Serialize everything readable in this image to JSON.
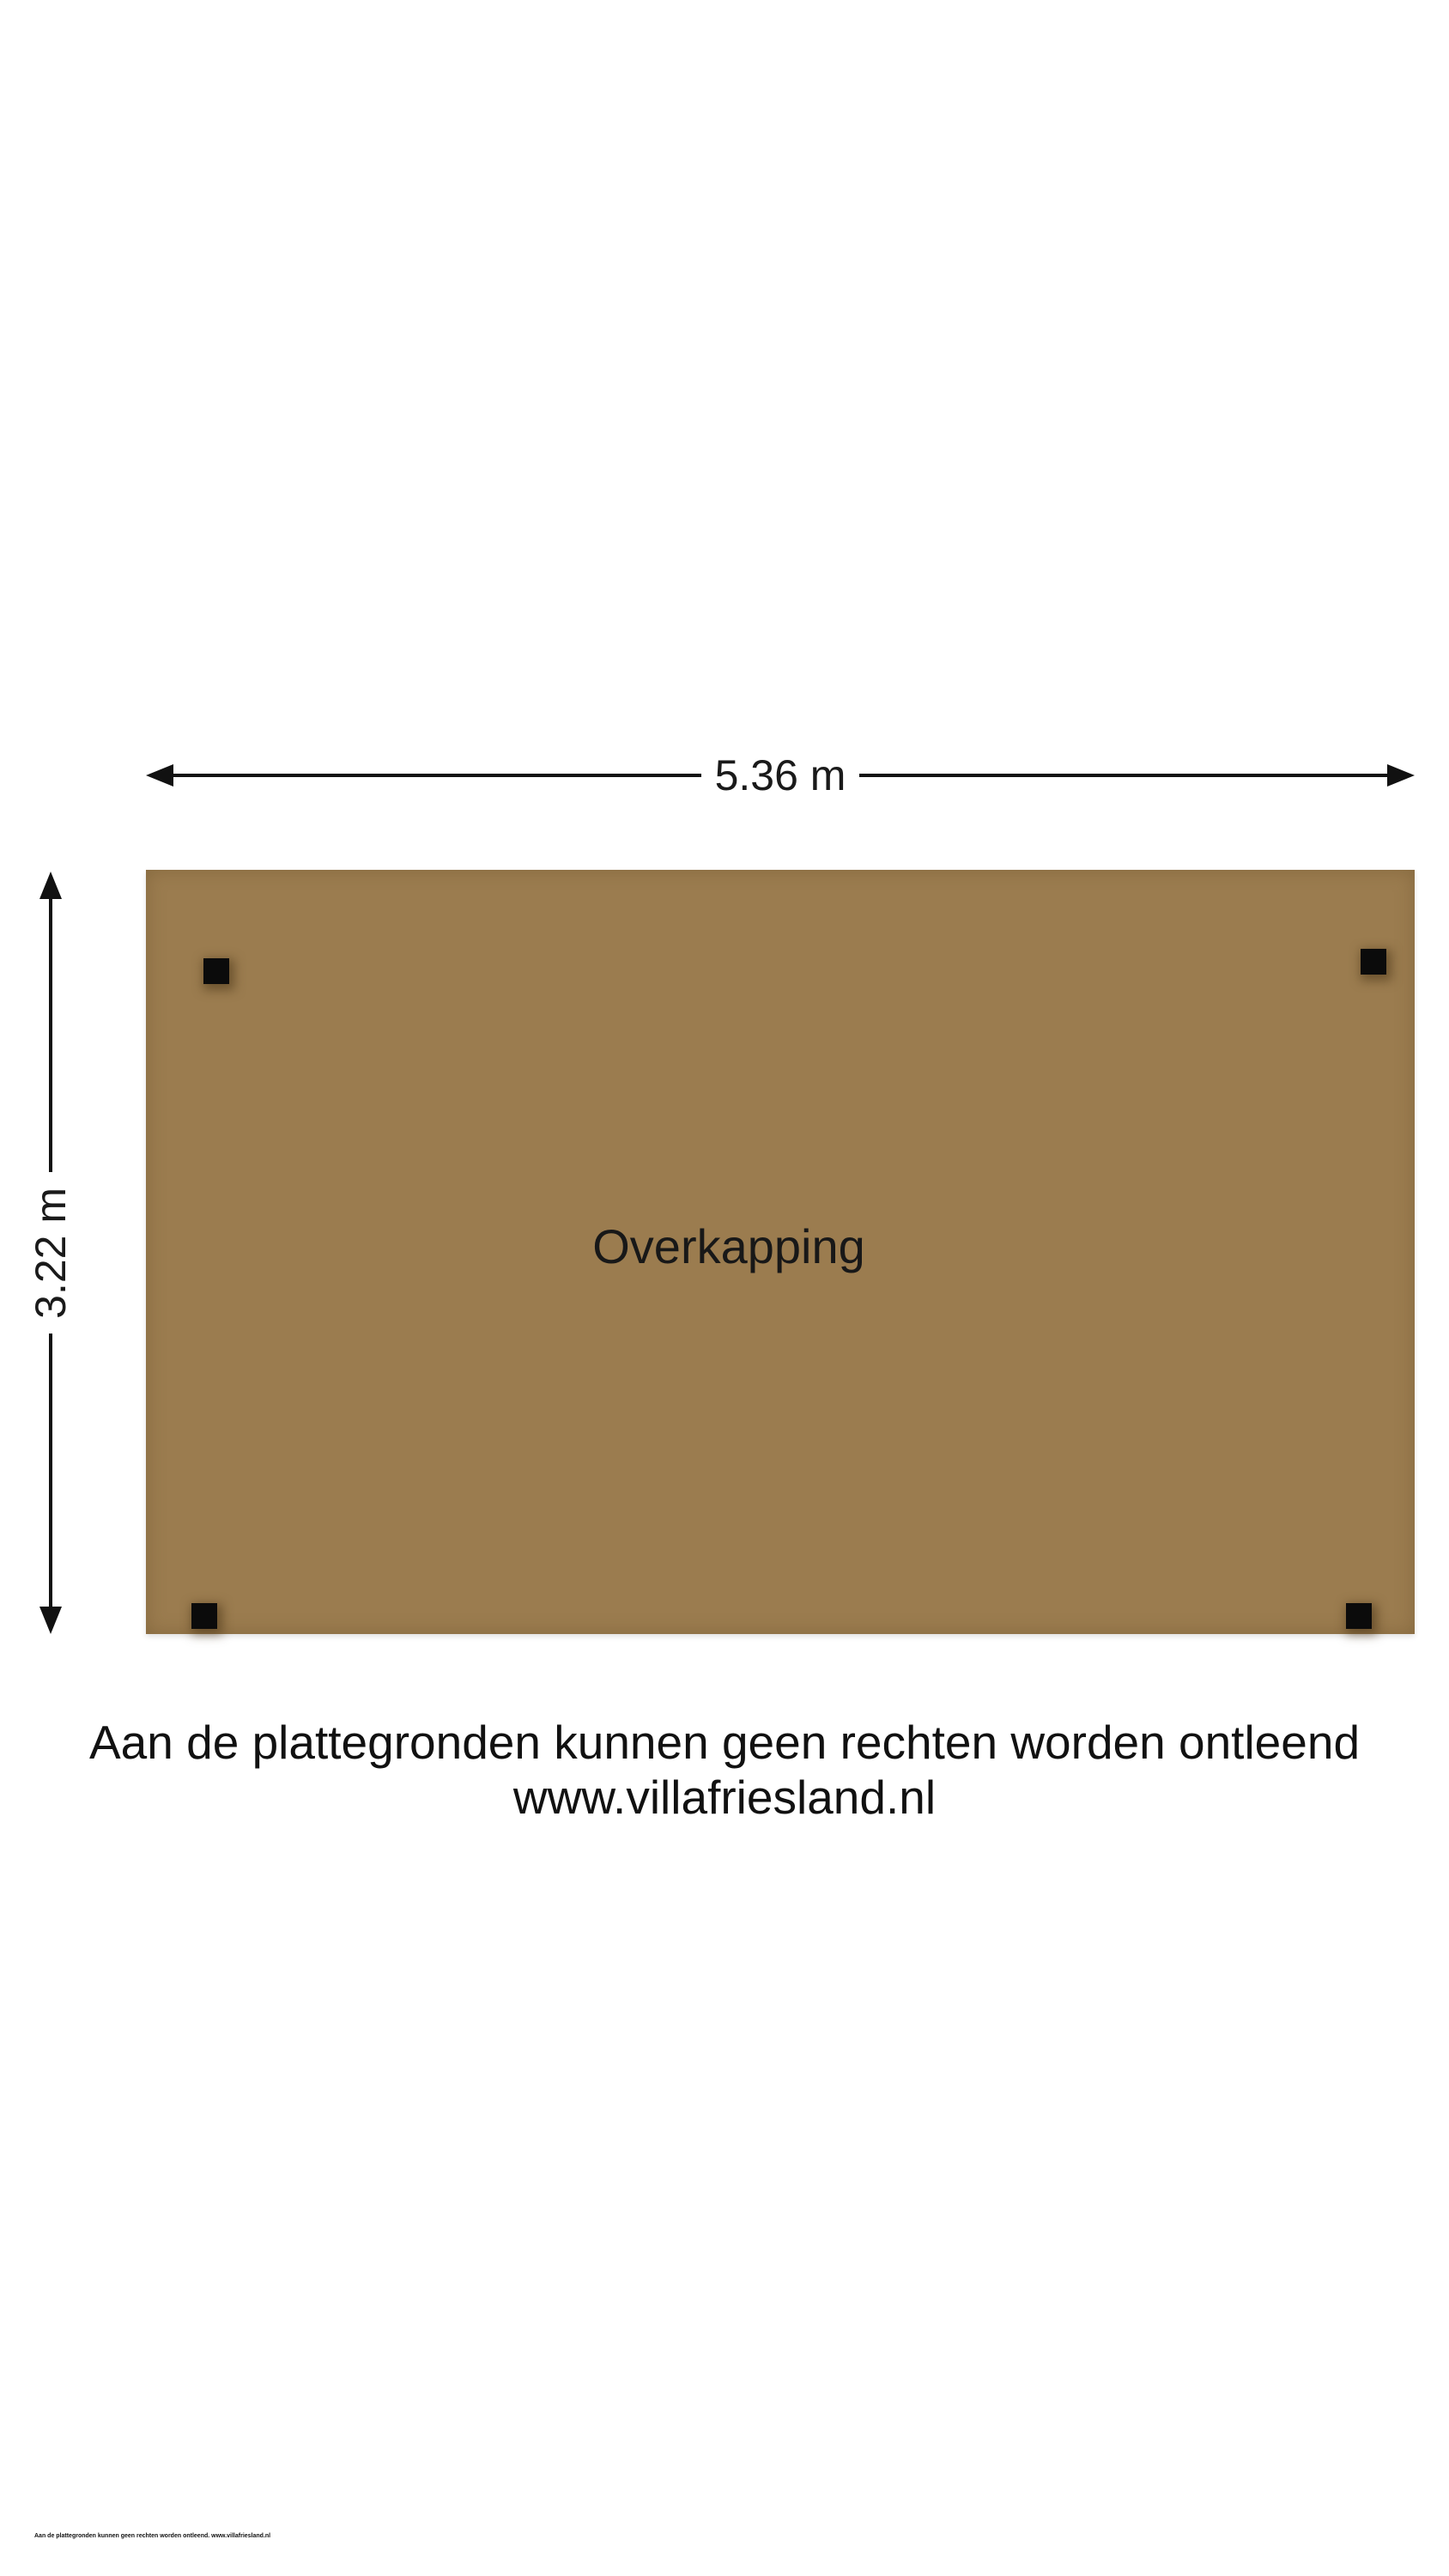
{
  "page": {
    "background_color": "#ffffff"
  },
  "floorplan": {
    "area_label": "Overkapping",
    "width_dimension": "5.36 m",
    "height_dimension": "3.22 m",
    "area_fill_color": "#9b7c4f",
    "post_color": "#0b0b0b",
    "dimension_line_color": "#111111",
    "posts": [
      "top-left",
      "top-right",
      "bottom-left",
      "bottom-right"
    ]
  },
  "caption": {
    "disclaimer": "Aan de plattegronden kunnen geen rechten worden ontleend",
    "website": "www.villafriesland.nl"
  },
  "fine_print": {
    "text": "Aan de plattegronden kunnen geen rechten worden ontleend. www.villafriesland.nl"
  }
}
